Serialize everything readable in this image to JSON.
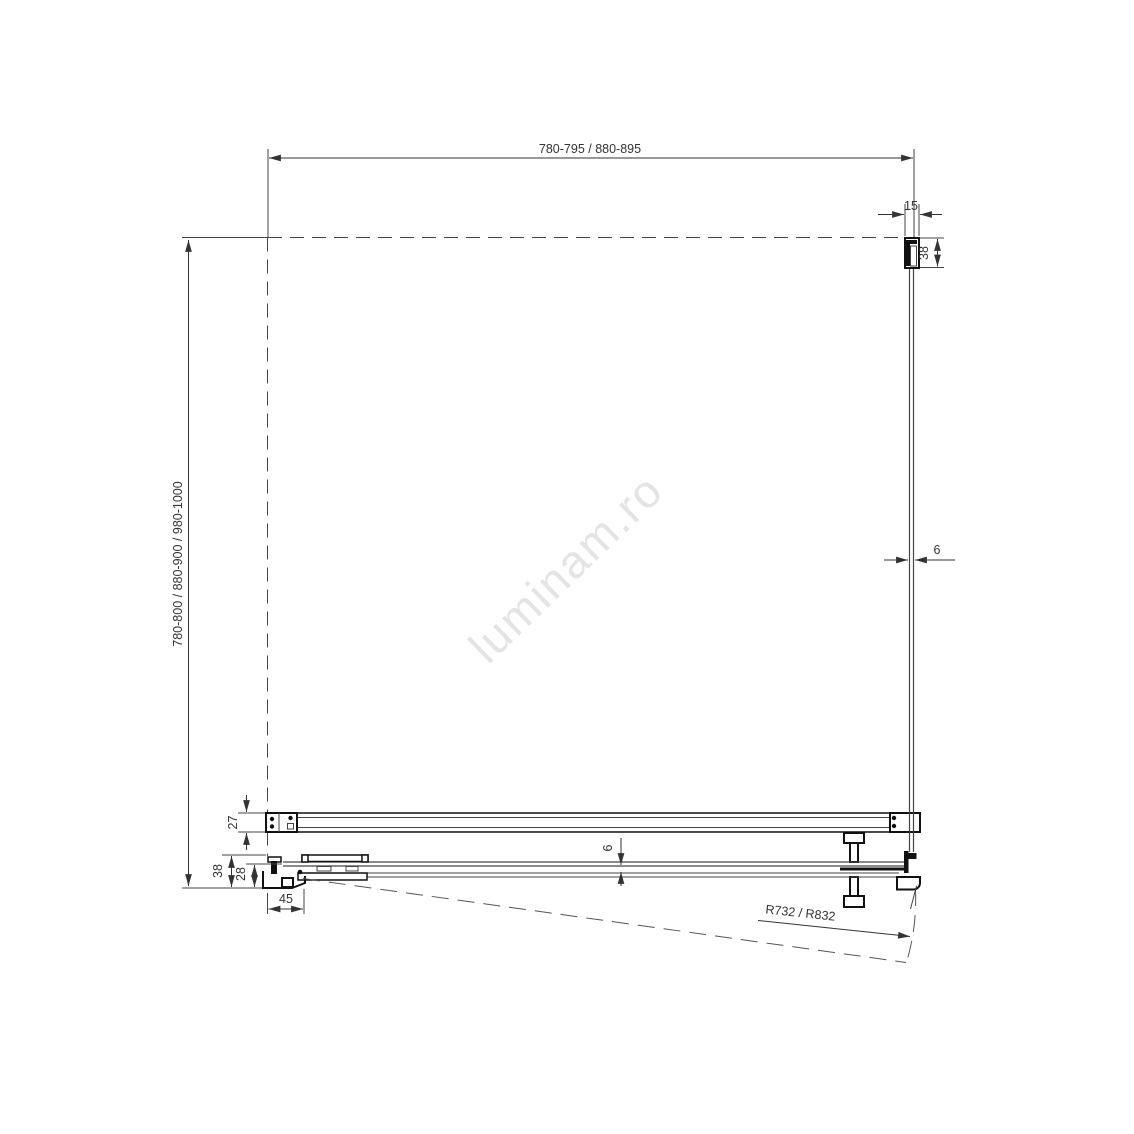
{
  "drawing_type": "shower-enclosure-plan-technical-drawing",
  "watermark": "luminam.ro",
  "dims": {
    "top_width": "780-795 / 880-895",
    "left_height": "780-800 / 880-900 / 980-1000",
    "wall_profile_width": "15",
    "wall_profile_depth": "38",
    "side_glass_thickness": "6",
    "support_bar_depth": "27",
    "door_glass_thickness": "6",
    "hinge_profile_depth": "38",
    "hinge_inner_depth": "28",
    "hinge_offset": "45",
    "door_swing_radius": "R732 / R832"
  },
  "colors": {
    "line": "#444444",
    "profile": "#111111",
    "text": "#333333",
    "watermark": "#e4e4e4",
    "background": "#ffffff"
  }
}
